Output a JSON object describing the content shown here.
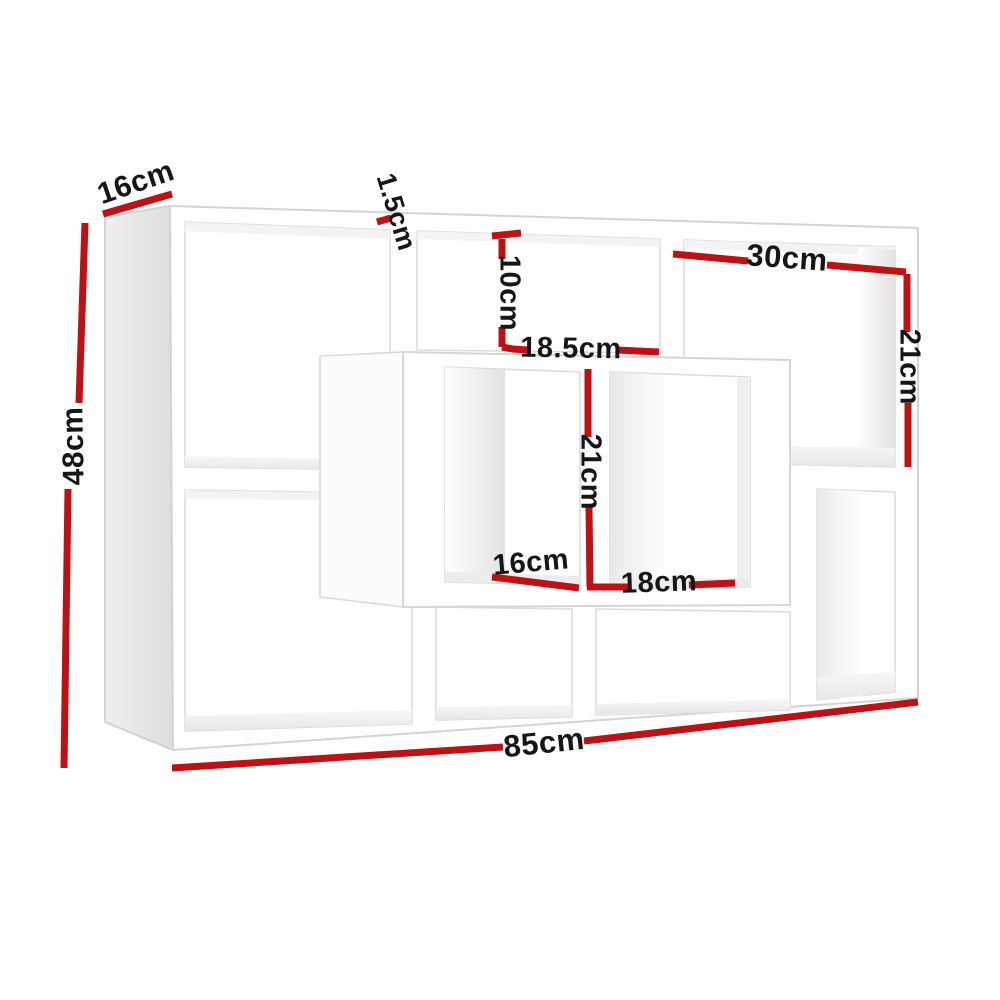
{
  "illustration": {
    "title": "floating-wall-shelf-dimension-diagram",
    "accent_red": "#bf1013",
    "text_color": "#161616",
    "shelf_fill": "#ffffff",
    "edge_color": "#d6d6d6",
    "side_panel_color": "#e6e6e6",
    "dimensions": [
      {
        "id": "depth",
        "label": "16cm",
        "cx": 136,
        "cy": 183,
        "rotate": -19,
        "size": 30,
        "segments": [
          [
            103,
            214,
            172,
            194
          ]
        ]
      },
      {
        "id": "overall-height",
        "label": "48cm",
        "cx": 74,
        "cy": 446,
        "rotate": -91,
        "size": 30,
        "segments": [
          [
            85,
            223,
            79,
            403
          ],
          [
            68,
            489,
            64,
            768
          ]
        ]
      },
      {
        "id": "board-thickness",
        "label": "1.5cm",
        "cx": 396,
        "cy": 212,
        "rotate": 73,
        "size": 27,
        "segments": [
          [
            377,
            222,
            391,
            218
          ]
        ]
      },
      {
        "id": "top-middle-opening-height",
        "label": "10cm",
        "cx": 509,
        "cy": 293,
        "rotate": 90,
        "size": 29,
        "segments": [
          [
            492,
            236,
            521,
            233
          ],
          [
            502,
            239,
            502,
            259
          ],
          [
            502,
            327,
            502,
            347
          ],
          [
            502,
            347,
            513,
            349
          ]
        ]
      },
      {
        "id": "top-middle-opening-width",
        "label": "18.5cm",
        "cx": 571,
        "cy": 349,
        "rotate": 1,
        "size": 29,
        "segments": [
          [
            512,
            349,
            529,
            350
          ],
          [
            616,
            350,
            659,
            352
          ]
        ]
      },
      {
        "id": "top-right-opening-width",
        "label": "30cm",
        "cx": 787,
        "cy": 258,
        "rotate": 4,
        "size": 31,
        "segments": [
          [
            673,
            254,
            748,
            261
          ],
          [
            827,
            265,
            906,
            272
          ]
        ]
      },
      {
        "id": "top-right-opening-height",
        "label": "21cm",
        "cx": 909,
        "cy": 367,
        "rotate": 90,
        "size": 29,
        "segments": [
          [
            907,
            274,
            907,
            332
          ],
          [
            908,
            403,
            908,
            467
          ]
        ]
      },
      {
        "id": "centre-opening-height",
        "label": "21cm",
        "cx": 590,
        "cy": 472,
        "rotate": 90,
        "size": 29,
        "segments": [
          [
            588,
            369,
            588,
            437
          ],
          [
            589,
            507,
            590,
            587
          ]
        ]
      },
      {
        "id": "centre-left-opening-width",
        "label": "16cm",
        "cx": 531,
        "cy": 563,
        "rotate": -5,
        "size": 29,
        "segments": [
          [
            492,
            577,
            579,
            588
          ]
        ]
      },
      {
        "id": "centre-right-opening-width",
        "label": "18cm",
        "cx": 659,
        "cy": 583,
        "rotate": -2,
        "size": 29,
        "segments": [
          [
            587,
            587,
            631,
            587
          ],
          [
            689,
            585,
            735,
            583
          ]
        ]
      },
      {
        "id": "overall-width",
        "label": "85cm",
        "cx": 544,
        "cy": 743,
        "rotate": -6,
        "size": 31,
        "segments": [
          [
            172,
            768,
            503,
            747
          ],
          [
            584,
            741,
            918,
            702
          ]
        ]
      }
    ]
  }
}
